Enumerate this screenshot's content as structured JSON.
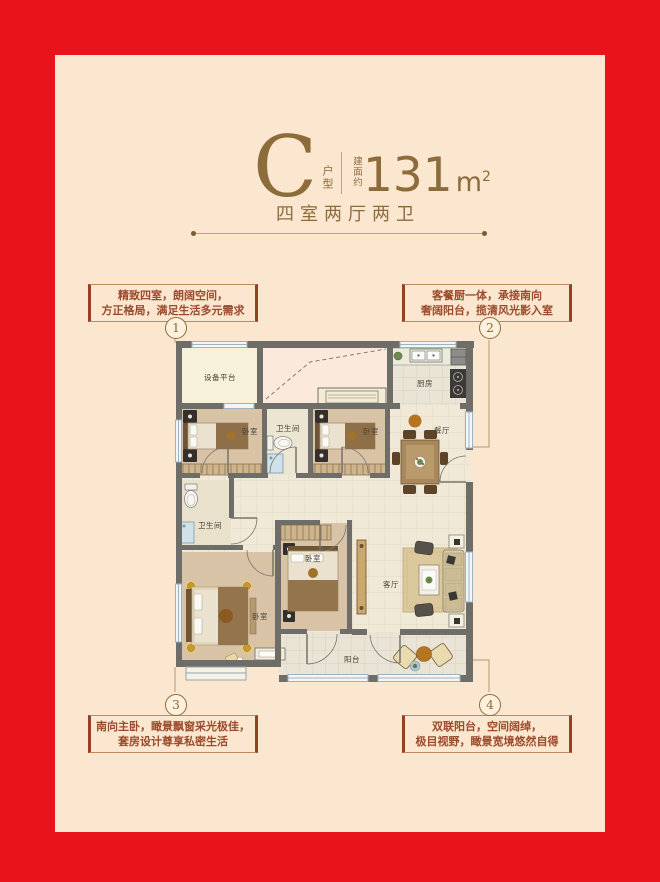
{
  "frame": {
    "border_color": "#e8131b",
    "panel_color": "#fbe6cf",
    "accent_color": "#8d6c3c"
  },
  "header": {
    "type_letter": "C",
    "type_label": "户型",
    "area_prefix": "建面约",
    "area_number": "131",
    "area_unit": "m",
    "area_sup": "2",
    "layout_summary": "四室两厅两卫"
  },
  "callouts": [
    {
      "num": "1",
      "line1": "精致四室，朗阔空间，",
      "line2": "方正格局，满足生活多元需求"
    },
    {
      "num": "2",
      "line1": "客餐厨一体，承接南向",
      "line2": "奢阔阳台，揽清风光影入室"
    },
    {
      "num": "3",
      "line1": "南向主卧，瞰景飘窗采光极佳，",
      "line2": "套房设计尊享私密生活"
    },
    {
      "num": "4",
      "line1": "双联阳台，空间阔绰，",
      "line2": "极目视野，瞰景宽境悠然自得"
    }
  ],
  "floor_plan": {
    "labels": {
      "equipment_platform": "设备平台",
      "kitchen": "厨房",
      "bedroom_top_left": "卧室",
      "bath_top": "卫生间",
      "bedroom_top_mid": "卧室",
      "dining": "餐厅",
      "bath_lower": "卫生间",
      "master_bedroom": "卧室",
      "bedroom_bottom_mid": "卧室",
      "living": "客厅",
      "balcony": "阳台"
    }
  }
}
